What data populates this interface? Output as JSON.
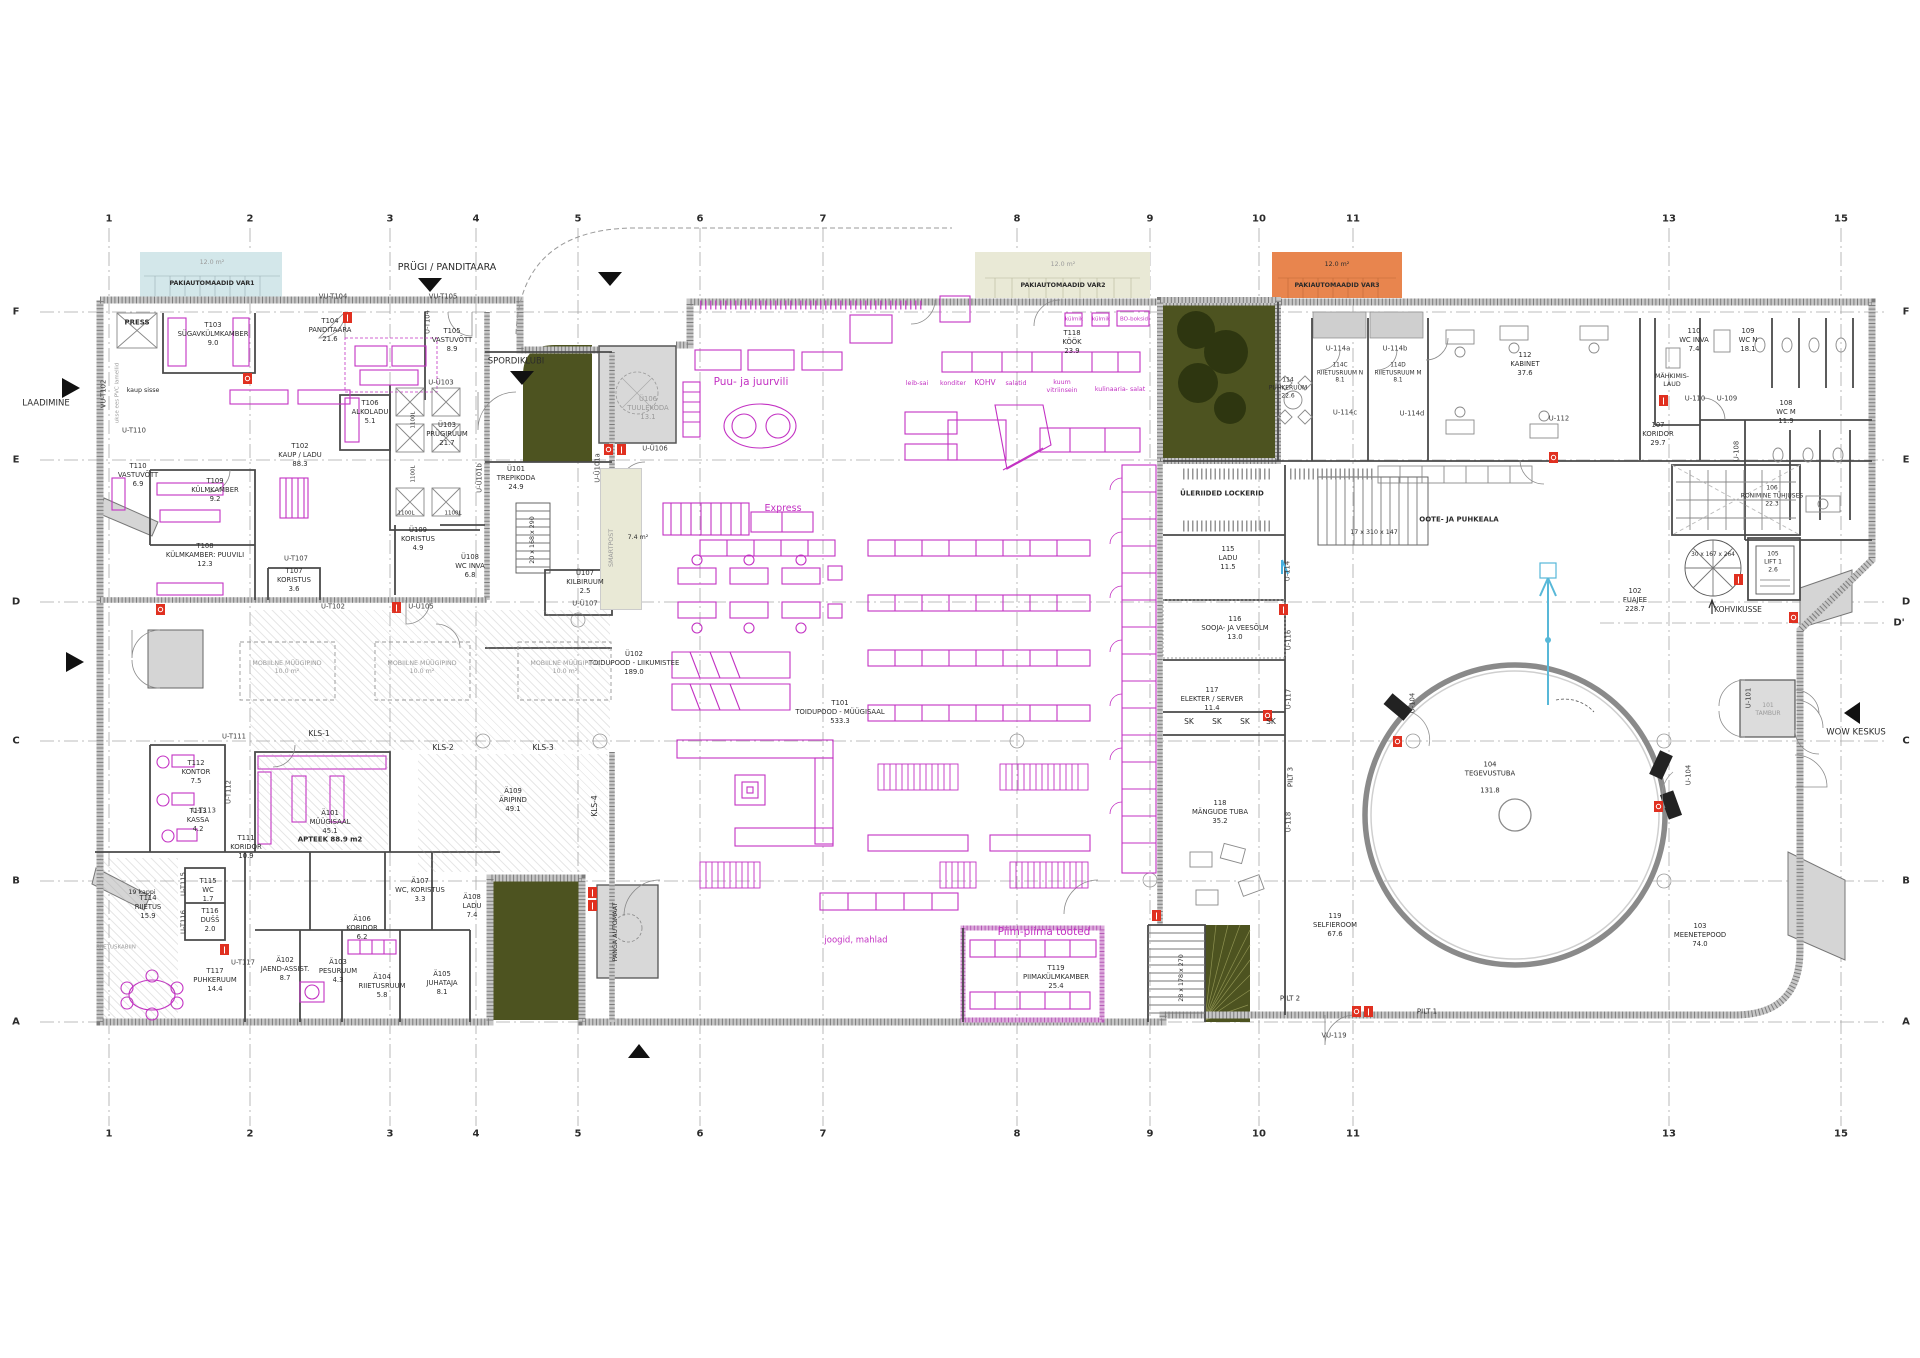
{
  "colors": {
    "magenta": "#c332c3",
    "olive": "#4d5320",
    "tree": "#2e3610",
    "orange": "#e8854e",
    "beige": "#e9e9d6",
    "blue_box": "#d3e7ea",
    "red_marker": "#e03020",
    "wall": "#c4c4c4"
  },
  "grid": {
    "cols": [
      "1",
      "2",
      "3",
      "4",
      "5",
      "6",
      "7",
      "8",
      "9",
      "10",
      "11",
      "13",
      "15"
    ],
    "rows": [
      "F",
      "E",
      "D",
      "C",
      "B",
      "A"
    ],
    "d_prime": "D'"
  },
  "annot": {
    "laadimine": "LAADIMINE",
    "prugi": "PRÜGI / PANDITAARA",
    "spordiklubi": "SPORDIKLUBI",
    "wow": "WOW KESKUS",
    "kohvikusse": "KOHVIKUSSE",
    "press": "PRESS",
    "kaup_sisse": "kaup sisse",
    "pvc": "ukse ees PVC lamellid",
    "smartpost": "SMARTPOST",
    "panga": "PANGA AUTOMAAT",
    "m74": "7.4 m²",
    "area12": "12.0 m²",
    "pak1": "PAKIAUTOMAADID VAR1",
    "pak2": "PAKIAUTOMAADID VAR2",
    "pak3": "PAKIAUTOMAADID VAR3",
    "mobiilne": "MOBIILNE MÜÜGIPIND\n10.0 m²",
    "kls1": "KLS-1",
    "kls2": "KLS-2",
    "kls3": "KLS-3",
    "kls4": "KLS-4",
    "pilt1": "PILT 1",
    "pilt2": "PILT 2",
    "pilt3": "PILT 3",
    "uleriided": "ÜLERIIDED LOCKERID",
    "oote": "OOTE- JA PUHKEALA",
    "mahkimis": "MÄHKIMIS-\nLAUD",
    "kappi19": "19 kappi",
    "sk": "SK",
    "stair_a": "20 x 168 x 290",
    "stair_b": "17 x 310 x 147",
    "stair_c": "30 x 167 x 264",
    "stair_d": "28 x 178 x 270",
    "apteek": "APTEEK 88.9 m2",
    "l1100": "1100L",
    "riietuskabiin": "RIIETUSKABIIN"
  },
  "rooms": {
    "t101": "T101\nTOIDUPOOD - MÜÜGISAAL\n533.3",
    "t102": "T102\nKAUP / LADU\n88.3",
    "t103": "T103\nSÜGAVKÜLMKAMBER\n9.0",
    "t104": "T104\nPANDITAARA\n21.6",
    "t105": "T105\nVASTUVÕTT\n8.9",
    "t106": "T106\nALKOLADU\n5.1",
    "t107": "T107\nKORISTUS\n3.6",
    "t108": "T108\nKÜLMKAMBER: PUUVILI\n12.3",
    "t109": "T109\nKÜLMKAMBER\n9.2",
    "t110": "T110\nVASTUVÕTT\n6.9",
    "t111": "T111\nKORIDOR\n10.9",
    "t112": "T112\nKONTOR\n7.5",
    "t113": "T113\nKASSA\n4.2",
    "t114": "T114\nRIIETUS\n15.9",
    "t115": "T115\nWC\n1.7",
    "t116": "T116\nDUŠŠ\n2.0",
    "t117": "T117\nPUHKERUUM\n14.4",
    "t118": "T118\nKÖÖK\n23.9",
    "t119": "T119\nPIIMAKÜLMKAMBER\n25.4",
    "u101": "Ü101\nTREPIKODA\n24.9",
    "u102": "Ü102\nTOIDUPOOD - LIIKUMISTEE\n189.0",
    "u103": "Ü103\nPRÜGIRUUM\n21.7",
    "u106": "Ü106\nTUULEKODA\n13.1",
    "u107": "Ü107\nKILBIRUUM\n2.5",
    "u108": "Ü108\nWC INVA\n6.8",
    "u109": "Ü109\nKORISTUS\n4.9",
    "a101": "Ä101\nMÜÜGISAAL\n45.1",
    "a102": "Ä102\nJAEND-ASSIST.\n8.7",
    "a103": "Ä103\nPESURUUM\n4.3",
    "a104": "Ä104\nRIIETUSRUUM\n5.8",
    "a105": "Ä105\nJUHATAJA\n8.1",
    "a106": "Ä106\nKORIDOR\n6.2",
    "a107": "Ä107\nWC, KORISTUS\n3.3",
    "a108": "Ä108\nLADU\n7.4",
    "a109": "Ä109\nÄRIPIND\n49.1",
    "r101": "101\nTAMBUR",
    "r102": "102\nFUAJEE\n228.7",
    "r103": "103\nMEENETEPOOD\n74.0",
    "r104": "104\nTEGEVUSTUBA\n\n131.8",
    "r105": "105\nLIFT 1\n2.6",
    "r106": "106\nRONIMINE TÜHJUSES\n22.3",
    "r107": "107\nKORIDOR\n29.7",
    "r108": "108\nWC M\n11.9",
    "r109": "109\nWC N\n18.1",
    "r110": "110\nWC INVA\n7.4",
    "r112": "112\nKABINET\n37.6",
    "r114": "114\nPUHKERUUM\n22.6",
    "r114c": "114C\nRIIETUSRUUM N\n8.1",
    "r114d": "114D\nRIIETUSRUUM M\n8.1",
    "r115": "115\nLADU\n11.5",
    "r116": "116\nSOOJA- JA VEESÕLM\n13.0",
    "r117": "117\nELEKTER / SERVER\n11.4",
    "r118": "118\nMÄNGUDE TUBA\n35.2",
    "r119": "119\nSELFIEROOM\n67.6"
  },
  "doors": {
    "vu_t102": "VU-T102",
    "vu_t104": "VU-T104",
    "vu_t105": "VU-T105",
    "vu_119": "VU-119",
    "u_t102": "U-T102",
    "u_t104": "U-T104",
    "u_t107": "U-T107",
    "u_t110": "U-T110",
    "u_t111": "U-T111",
    "u_t112": "U-T112",
    "u_t113": "U-T113",
    "u_t115": "U-T115",
    "u_t116": "U-T116",
    "u_t117": "U-T117",
    "u_u101a": "U-Ü101a",
    "u_u101b": "U-Ü101b",
    "u_u103": "U-Ü103",
    "u_u105": "U-Ü105",
    "u_u106": "U-Ü106",
    "u_u107": "U-Ü107",
    "u_101": "U-101",
    "u_104": "U-104",
    "u_108": "U-108",
    "u_109": "U-109",
    "u_110": "U-110",
    "u_112": "U-112",
    "u_114": "U-114",
    "u_114a": "U-114a",
    "u_114b": "U-114b",
    "u_114c": "U-114c",
    "u_114d": "U-114d",
    "u_116": "U-116",
    "u_117": "U-117",
    "u_118": "U-118"
  },
  "retail": {
    "puu": "Puu- ja juurvili",
    "express": "Express",
    "joogid": "joogid, mahlad",
    "piim": "Piim-piima tooted",
    "leib": "leib-sai",
    "konditer": "konditer",
    "kohv": "KOHV",
    "salatid": "salatid",
    "kuum": "kuum\nvitriinsein",
    "kulinaaria": "kulinaaria- salat",
    "bo": "BO-boksid",
    "kylmik": "külmik"
  }
}
